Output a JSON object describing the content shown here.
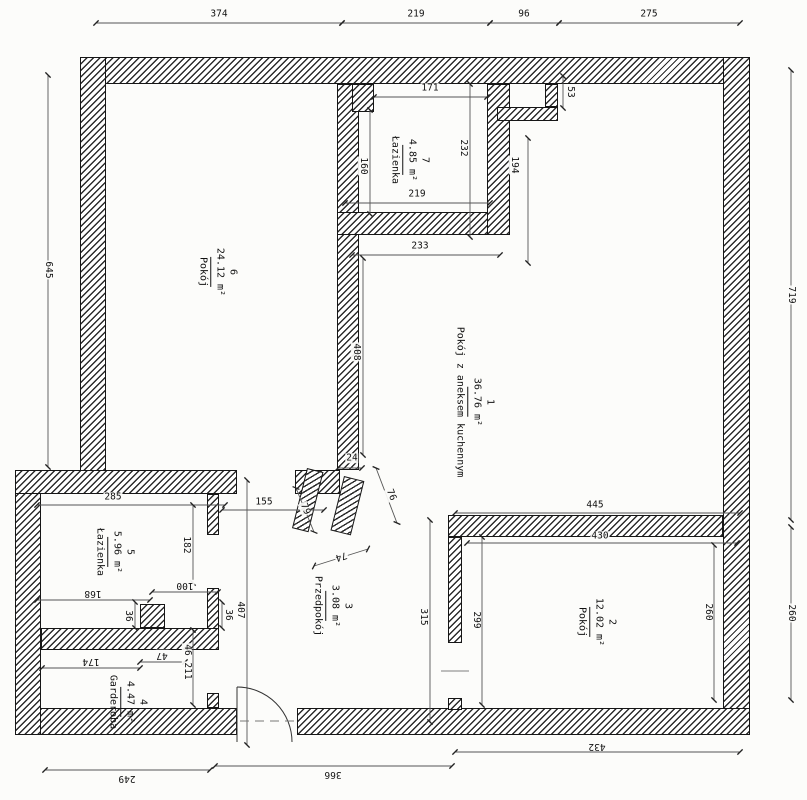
{
  "drawing": {
    "type": "architectural floor plan",
    "language": "Polish",
    "units": "cm"
  },
  "colors": {
    "ink": "#1a1a1a",
    "paper": "#fcfcfa",
    "hatch": "#2b2b2b"
  },
  "rooms": [
    {
      "num": "1",
      "area": "36.76 m²",
      "name": "Pokój z aneksem kuchennym",
      "x": 474,
      "y": 402
    },
    {
      "num": "2",
      "area": "12.02 m²",
      "name": "Pokój",
      "x": 596,
      "y": 622
    },
    {
      "num": "3",
      "area": "3.08 m²",
      "name": "Przedpokój",
      "x": 332,
      "y": 606
    },
    {
      "num": "4",
      "area": "4.47 m²",
      "name": "Garderoba",
      "x": 127,
      "y": 702
    },
    {
      "num": "5",
      "area": "5.96 m²",
      "name": "Łazienka",
      "x": 114,
      "y": 552
    },
    {
      "num": "6",
      "area": "24.12 m²",
      "name": "Pokój",
      "x": 217,
      "y": 272
    },
    {
      "num": "7",
      "area": "4.85 m²",
      "name": "Łazienka",
      "x": 409,
      "y": 160
    }
  ],
  "dims": [
    {
      "v": "374",
      "x": 219,
      "y": 14,
      "r": 0
    },
    {
      "v": "219",
      "x": 416,
      "y": 14,
      "r": 0
    },
    {
      "v": "96",
      "x": 524,
      "y": 14,
      "r": 0
    },
    {
      "v": "275",
      "x": 649,
      "y": 14,
      "r": 0
    },
    {
      "v": "645",
      "x": 48,
      "y": 270,
      "r": 90
    },
    {
      "v": "719",
      "x": 791,
      "y": 295,
      "r": 90
    },
    {
      "v": "260",
      "x": 791,
      "y": 613,
      "r": 90
    },
    {
      "v": "249",
      "x": 127,
      "y": 778,
      "r": 180
    },
    {
      "v": "366",
      "x": 333,
      "y": 774,
      "r": 180
    },
    {
      "v": "432",
      "x": 597,
      "y": 746,
      "r": 180
    },
    {
      "v": "285",
      "x": 113,
      "y": 497,
      "r": 0
    },
    {
      "v": "182",
      "x": 186,
      "y": 545,
      "r": 90
    },
    {
      "v": "168",
      "x": 93,
      "y": 593,
      "r": 180
    },
    {
      "v": "100",
      "x": 185,
      "y": 585,
      "r": 180
    },
    {
      "v": "174",
      "x": 91,
      "y": 661,
      "r": 180
    },
    {
      "v": "47",
      "x": 162,
      "y": 655,
      "r": 180
    },
    {
      "v": "36",
      "x": 128,
      "y": 616,
      "r": 90
    },
    {
      "v": "36",
      "x": 228,
      "y": 615,
      "r": 90
    },
    {
      "v": "46",
      "x": 187,
      "y": 650,
      "r": 90
    },
    {
      "v": "211",
      "x": 187,
      "y": 671,
      "r": 90
    },
    {
      "v": "407",
      "x": 240,
      "y": 610,
      "r": 90
    },
    {
      "v": "155",
      "x": 264,
      "y": 502,
      "r": 0
    },
    {
      "v": "79",
      "x": 305,
      "y": 509,
      "r": 68
    },
    {
      "v": "76",
      "x": 391,
      "y": 495,
      "r": 68
    },
    {
      "v": "74",
      "x": 341,
      "y": 556,
      "r": 163
    },
    {
      "v": "24",
      "x": 352,
      "y": 458,
      "r": 0
    },
    {
      "v": "233",
      "x": 420,
      "y": 246,
      "r": 0
    },
    {
      "v": "408",
      "x": 356,
      "y": 352,
      "r": 90
    },
    {
      "v": "171",
      "x": 430,
      "y": 88,
      "r": 0
    },
    {
      "v": "160",
      "x": 363,
      "y": 166,
      "r": 90
    },
    {
      "v": "232",
      "x": 463,
      "y": 148,
      "r": 90
    },
    {
      "v": "219",
      "x": 417,
      "y": 194,
      "r": 0
    },
    {
      "v": "53",
      "x": 570,
      "y": 92,
      "r": 90
    },
    {
      "v": "194",
      "x": 514,
      "y": 165,
      "r": 90
    },
    {
      "v": "445",
      "x": 595,
      "y": 505,
      "r": 0
    },
    {
      "v": "430",
      "x": 600,
      "y": 536,
      "r": 0
    },
    {
      "v": "315",
      "x": 423,
      "y": 617,
      "r": 90
    },
    {
      "v": "299",
      "x": 476,
      "y": 620,
      "r": 90
    },
    {
      "v": "260",
      "x": 708,
      "y": 612,
      "r": 90
    }
  ]
}
